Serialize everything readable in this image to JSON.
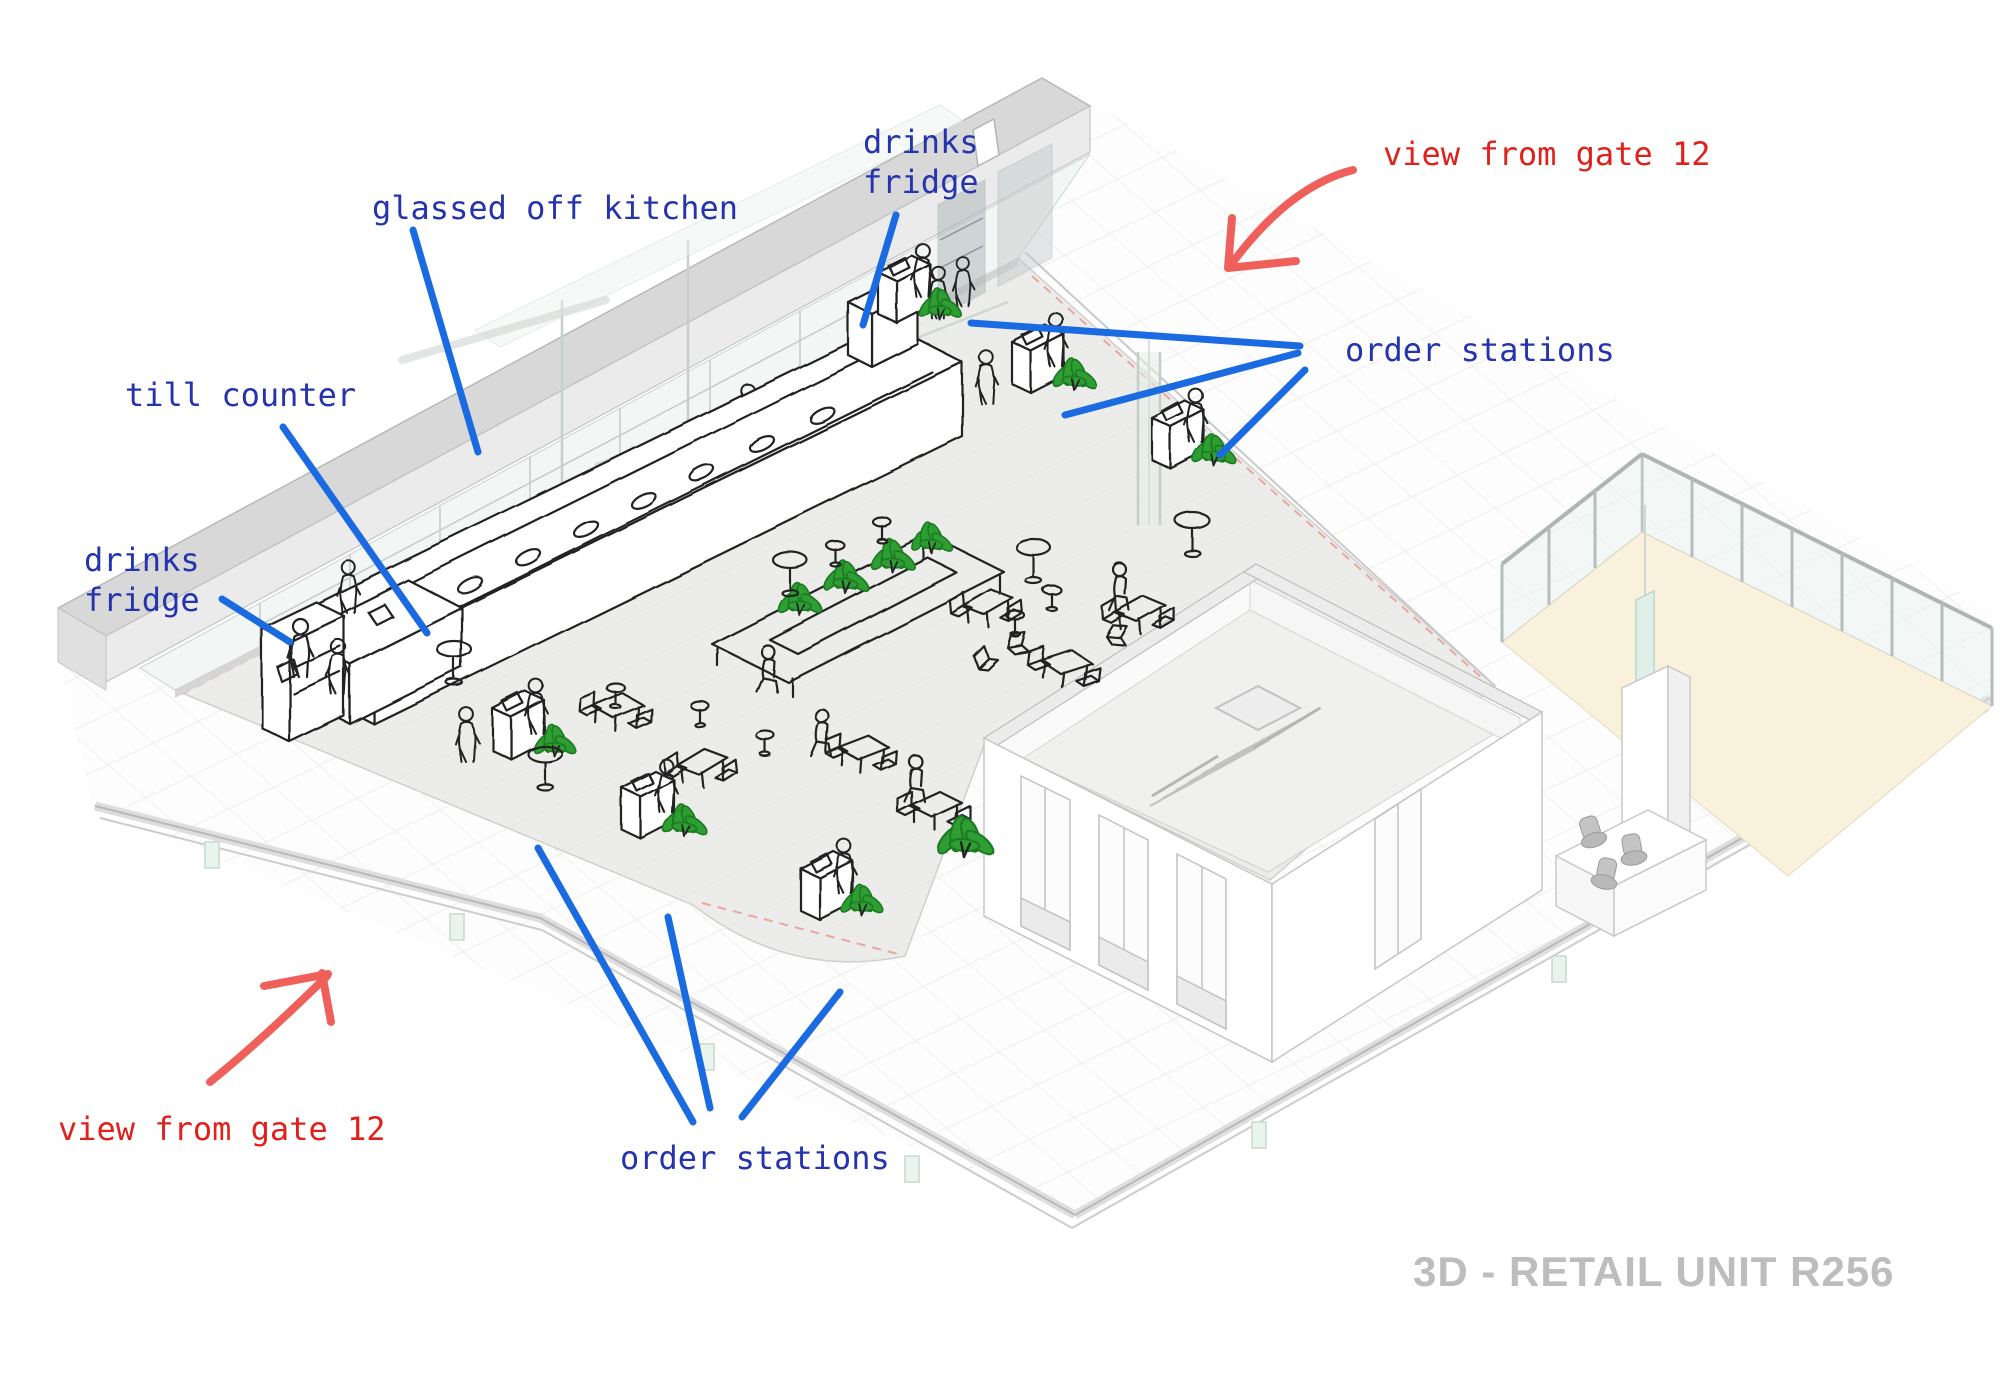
{
  "drawing_title": "3D - RETAIL UNIT R256",
  "annotations": {
    "drinks_fridge_top": {
      "line1": "drinks",
      "line2": "fridge"
    },
    "glassed_off_kitchen": "glassed off kitchen",
    "till_counter": "till counter",
    "drinks_fridge_left": {
      "line1": "drinks",
      "line2": "fridge"
    },
    "order_stations_right": "order stations",
    "order_stations_bottom": "order stations",
    "view_from_gate_top": "view from gate 12",
    "view_from_gate_bottom": "view from gate 12"
  },
  "colors": {
    "annotation_blue": "#2433ae",
    "leader_blue": "#1a6ae1",
    "annotation_red": "#e0211b",
    "arrow_red": "#ee6059",
    "title_gray": "#bdbdbd",
    "plant_green": "#2f9e33",
    "sketch_ink": "#222222",
    "floor_gray": "#ececea",
    "wall_gray": "#d8d8d8",
    "terrace_cream": "#faf1dc",
    "boundary_pink": "#ea9a94"
  }
}
